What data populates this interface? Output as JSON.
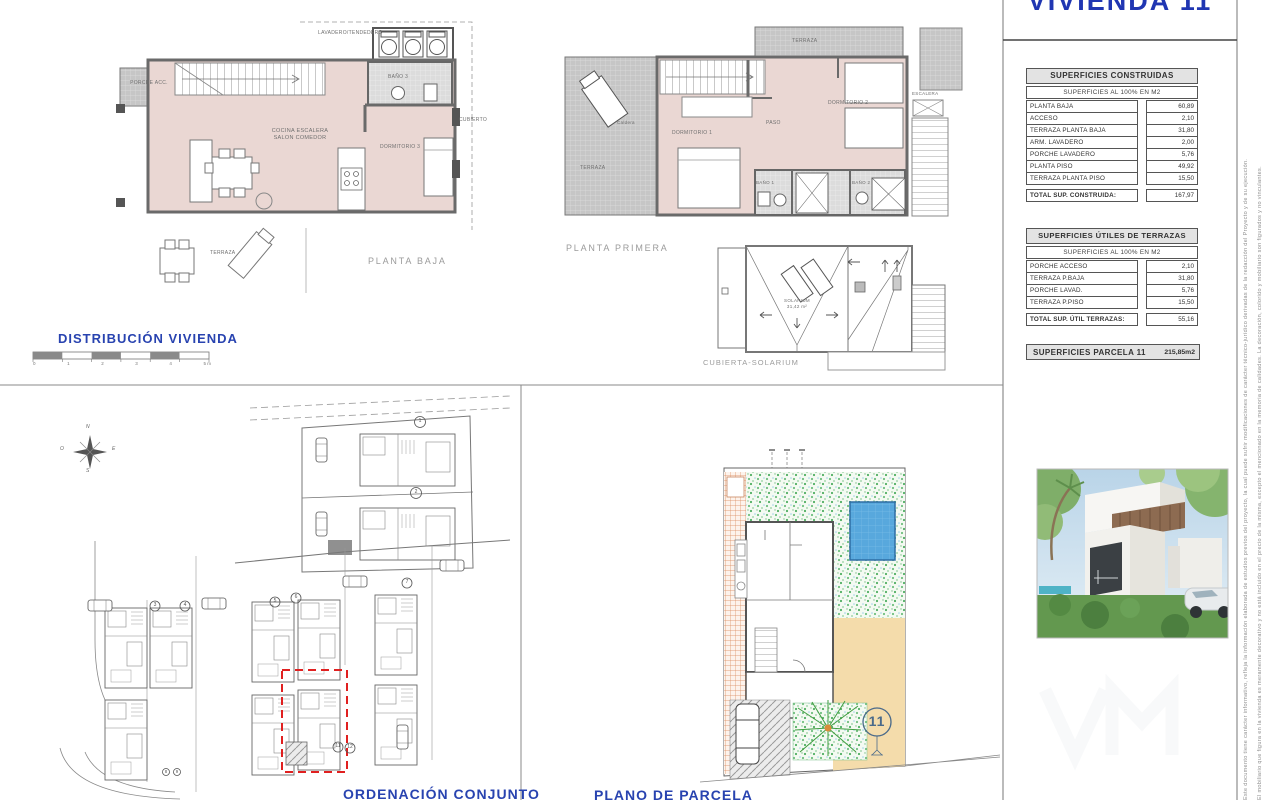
{
  "title": "VIVIENDA 11",
  "panel": {
    "construidas": {
      "title": "SUPERFICIES CONSTRUIDAS",
      "subtitle": "SUPERFICIES AL 100% EN M2",
      "rows": [
        {
          "label": "PLANTA BAJA",
          "value": "60,89"
        },
        {
          "label": "ACCESO",
          "value": "2,10"
        },
        {
          "label": "TERRAZA PLANTA BAJA",
          "value": "31,80"
        },
        {
          "label": "ARM. LAVADERO",
          "value": "2,00"
        },
        {
          "label": "PORCHE LAVADERO",
          "value": "5,76"
        },
        {
          "label": "PLANTA PISO",
          "value": "49,92"
        },
        {
          "label": "TERRAZA PLANTA PISO",
          "value": "15,50"
        }
      ],
      "total_label": "TOTAL SUP. CONSTRUIDA:",
      "total_value": "167,97"
    },
    "terrazas": {
      "title": "SUPERFICIES ÚTILES DE TERRAZAS",
      "subtitle": "SUPERFICIES AL 100% EN M2",
      "rows": [
        {
          "label": "PORCHE ACCESO",
          "value": "2,10"
        },
        {
          "label": "TERRAZA P.BAJA",
          "value": "31,80"
        },
        {
          "label": "PORCHE LAVAD.",
          "value": "5,76"
        },
        {
          "label": "TERRAZA P.PISO",
          "value": "15,50"
        }
      ],
      "total_label": "TOTAL SUP. ÚTIL TERRAZAS:",
      "total_value": "55,16"
    },
    "parcela_label": "SUPERFICIES PARCELA 11",
    "parcela_value": "215,85m2"
  },
  "planta_baja": {
    "caption": "PLANTA BAJA",
    "labels": {
      "lavadero": "LAVADERO/TENDEDERO",
      "porche_acc": "PORCHE ACC.",
      "bano3": "BAÑO 3",
      "cubierto": "CUBIERTO",
      "cocina": "COCINA ESCALERA\nSALON COMEDOR",
      "dormitorio3": "DORMITORIO 3",
      "terraza": "TERRAZA"
    }
  },
  "planta_primera": {
    "caption": "PLANTA PRIMERA",
    "labels": {
      "terraza_top": "TERRAZA",
      "escalera": "ESCALERA",
      "caldera": "Caldera",
      "terraza_left": "TERRAZA",
      "dormitorio1": "DORMITORIO 1",
      "paso": "PASO",
      "dormitorio2": "DORMITORIO 2",
      "bano1": "BAÑO 1",
      "bano2": "BAÑO 2"
    }
  },
  "cubierta": {
    "caption": "CUBIERTA-SOLARIUM",
    "solarium": "SOLARIUM\n31,42 m²"
  },
  "distribucion": {
    "label": "DISTRIBUCIÓN VIVIENDA",
    "scale_ticks": [
      "0",
      "1",
      "2",
      "3",
      "4",
      "5 m"
    ]
  },
  "ordenacion": {
    "caption": "ORDENACIÓN CONJUNTO",
    "compass": {
      "n": "N",
      "e": "E",
      "s": "S",
      "o": "O"
    },
    "plots": {
      "p1": "1",
      "p2": "2",
      "p3": "3",
      "p4": "4",
      "p5": "5",
      "p6": "6",
      "p7": "7",
      "p8": "8",
      "p9": "9",
      "p11": "11",
      "p12": "12"
    }
  },
  "parcela": {
    "caption": "PLANO DE PARCELA",
    "plot_number": "11"
  },
  "disclaimer": {
    "line1": "Este documento tiene carácter informativo, refleja la información elaborada de estudios previos del proyecto, la cual puede sufrir modificaciones de carácter técnico-jurídico derivadas de la redacción del Proyecto y de su ejecución.",
    "line2": "El mobiliario que figura en la vivienda es meramente decorativo y no está incluido en el precio de la misma, excepto el mencionado en la memoria de calidades. La decoración, colorido y mobiliario son figurados y no vinculantes."
  },
  "colors": {
    "accent_blue": "#2036b2",
    "caption_blue": "#2843b0",
    "caption_gray": "#9b9b9b",
    "plan_pink": "#ead7d3",
    "pool_blue": "#58a8dd",
    "garden_green": "#7cc089",
    "sand_beige": "#f4dcab",
    "terracotta": "#d9885a",
    "highlight_red": "#e02020"
  }
}
